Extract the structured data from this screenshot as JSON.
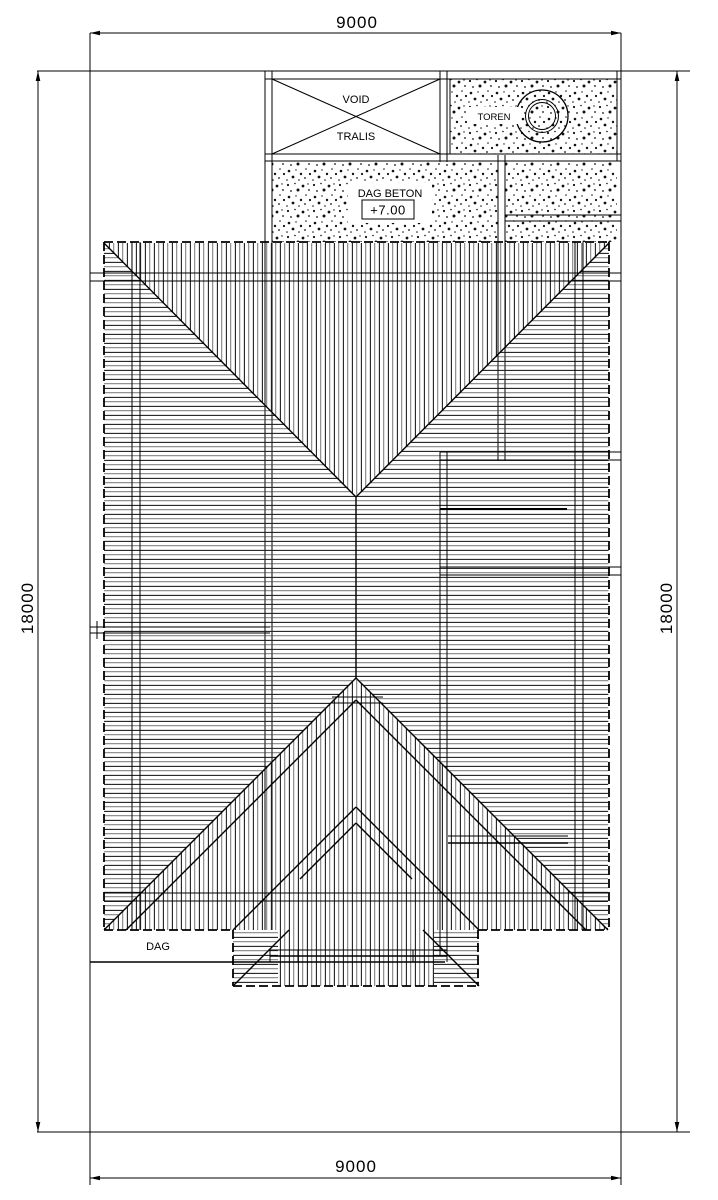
{
  "drawing": {
    "dimensions": {
      "top": "9000",
      "bottom": "9000",
      "left": "18000",
      "right": "18000"
    },
    "labels": {
      "void": "VOID",
      "tralis": "TRALIS",
      "toren": "TOREN",
      "dag_beton": "DAG BETON",
      "dag_beton_level": "+7.00",
      "dag": "DAG"
    },
    "colors": {
      "line": "#000000",
      "hatch": "#1f1f1f",
      "background": "#ffffff"
    }
  }
}
